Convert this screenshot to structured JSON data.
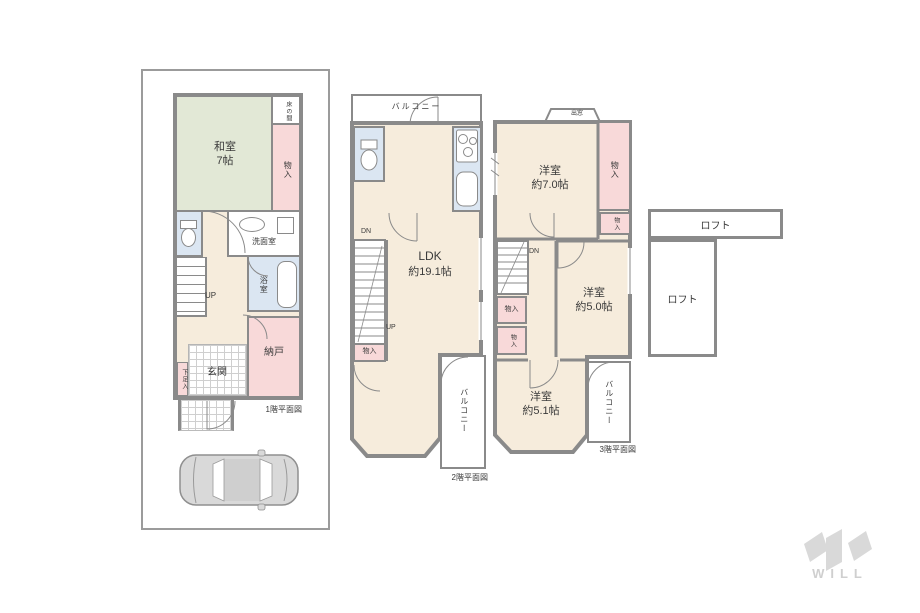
{
  "colors": {
    "wall": "#8a8a8a",
    "beige": "#f6ecdc",
    "green": "#e2e8d6",
    "pink": "#f8d9d9",
    "blue": "#dbe6f2",
    "logo": "#d9d9d9"
  },
  "floor1": {
    "caption": "1階平面図",
    "rooms": {
      "washitsu_name": "和室",
      "washitsu_size": "7帖",
      "tokonoma": "床の間",
      "closet": "物入",
      "senmen": "洗面室",
      "bath": "浴室",
      "nando": "納戸",
      "genkan": "玄関",
      "shoe_box": "下足入"
    },
    "stairs_up": "UP"
  },
  "floor2": {
    "caption": "2階平面図",
    "balcony_top": "バルコニー",
    "balcony_side": "バルコニー",
    "ldk_name": "LDK",
    "ldk_size": "約19.1帖",
    "closet": "物入",
    "stairs_dn": "DN",
    "stairs_up": "UP"
  },
  "floor3": {
    "caption": "3階平面図",
    "bay_window": "出窓",
    "room7_name": "洋室",
    "room7_size": "約7.0帖",
    "room5_name": "洋室",
    "room5_size": "約5.0帖",
    "room51_name": "洋室",
    "room51_size": "約5.1帖",
    "closet_right_tall": "物入",
    "closet_right_small": "物入",
    "closet_left_1": "物入",
    "closet_left_2": "物入",
    "stairs_dn": "DN",
    "balcony": "バルコニー"
  },
  "loft": {
    "upper_label": "ロフト",
    "lower_label": "ロフト"
  },
  "logo": {
    "brand": "WILL"
  }
}
